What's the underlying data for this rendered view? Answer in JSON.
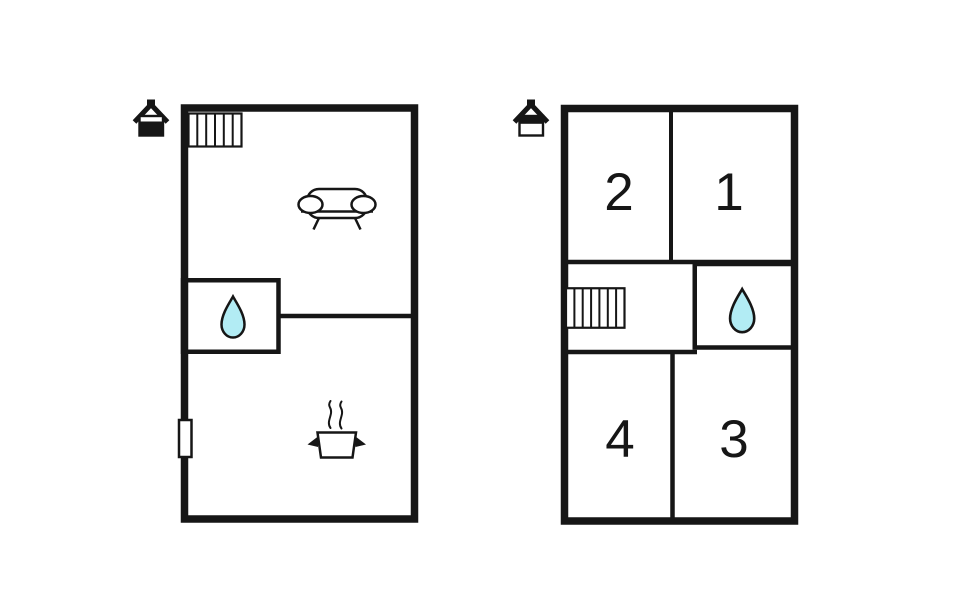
{
  "colors": {
    "ink": "#161616",
    "water": "#b2ecf4",
    "background": "#ffffff"
  },
  "icons": {
    "ground_floor_marker": "house-ground-floor-icon",
    "upper_floor_marker": "house-upper-floor-icon",
    "staircase": "staircase-icon",
    "water": "water-drop-icon",
    "sofa": "sofa-icon",
    "stove": "steaming-pot-icon",
    "door": "door-opening"
  },
  "upper_floor": {
    "rooms": [
      {
        "label": "2"
      },
      {
        "label": "1"
      },
      {
        "label": "4"
      },
      {
        "label": "3"
      }
    ]
  }
}
